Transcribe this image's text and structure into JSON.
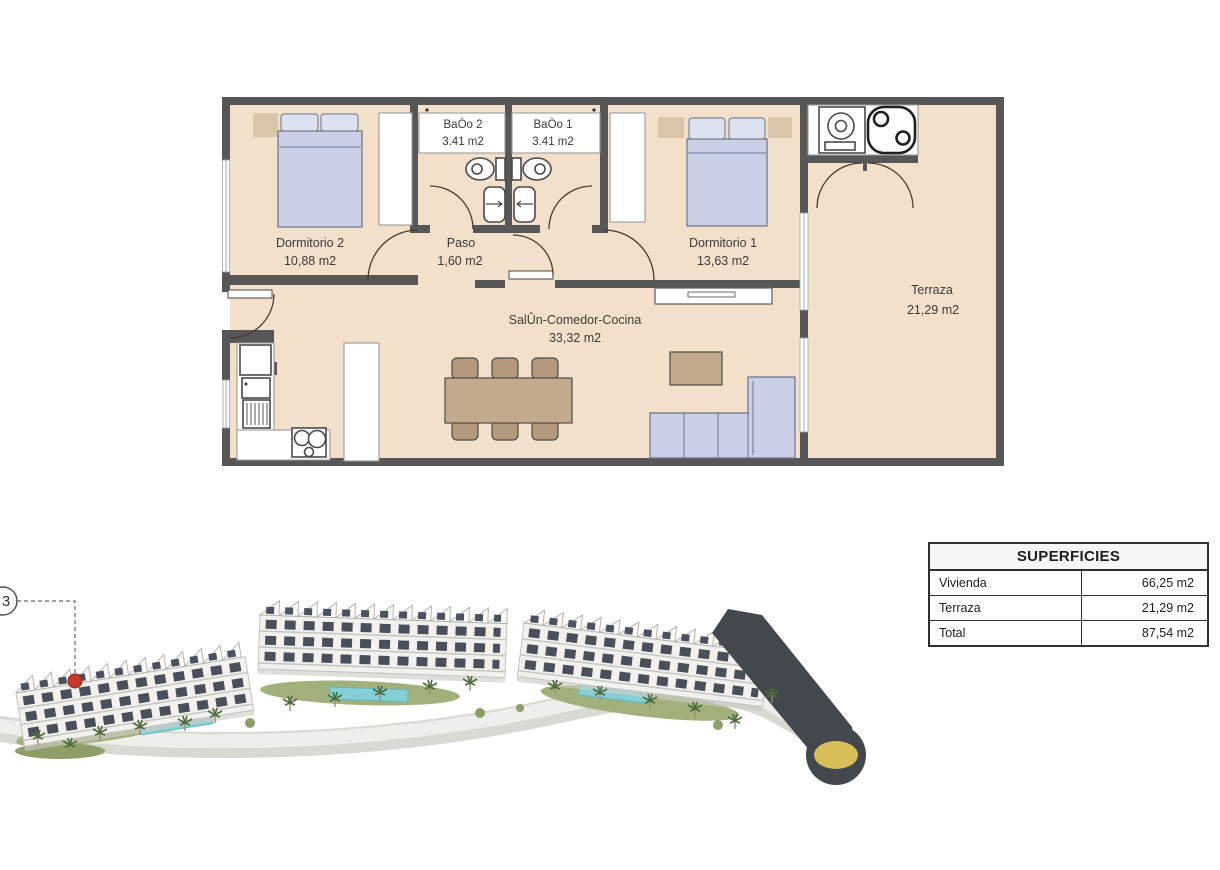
{
  "floorplan": {
    "rooms": [
      {
        "name": "Dormitorio 2",
        "area": "10,88 m2"
      },
      {
        "name": "BaÒo 2",
        "area": "3.41 m2"
      },
      {
        "name": "BaÒo 1",
        "area": "3.41 m2"
      },
      {
        "name": "Dormitorio 1",
        "area": "13,63 m2"
      },
      {
        "name": "Paso",
        "area": "1,60 m2"
      },
      {
        "name": "SalÛn-Comedor-Cocina",
        "area": "33,32 m2"
      },
      {
        "name": "Terraza",
        "area": "21,29 m2"
      }
    ],
    "colors": {
      "floor": "#f3e0ca",
      "walls": "#575757",
      "bed_sofa": "#c9d0e5",
      "wood": "#c2aa8d"
    }
  },
  "superficies_table": {
    "title": "SUPERFICIES",
    "rows": [
      {
        "label": "Vivienda",
        "value": "66,25 m2"
      },
      {
        "label": "Terraza",
        "value": "21,29 m2"
      },
      {
        "label": "Total",
        "value": "87,54 m2"
      }
    ]
  },
  "site_plan": {
    "marker_label": "3",
    "colors": {
      "road": "#43484e",
      "roundabout_center": "#d8be56",
      "pool": "#85d0d6",
      "marker": "#c63a2a"
    }
  }
}
